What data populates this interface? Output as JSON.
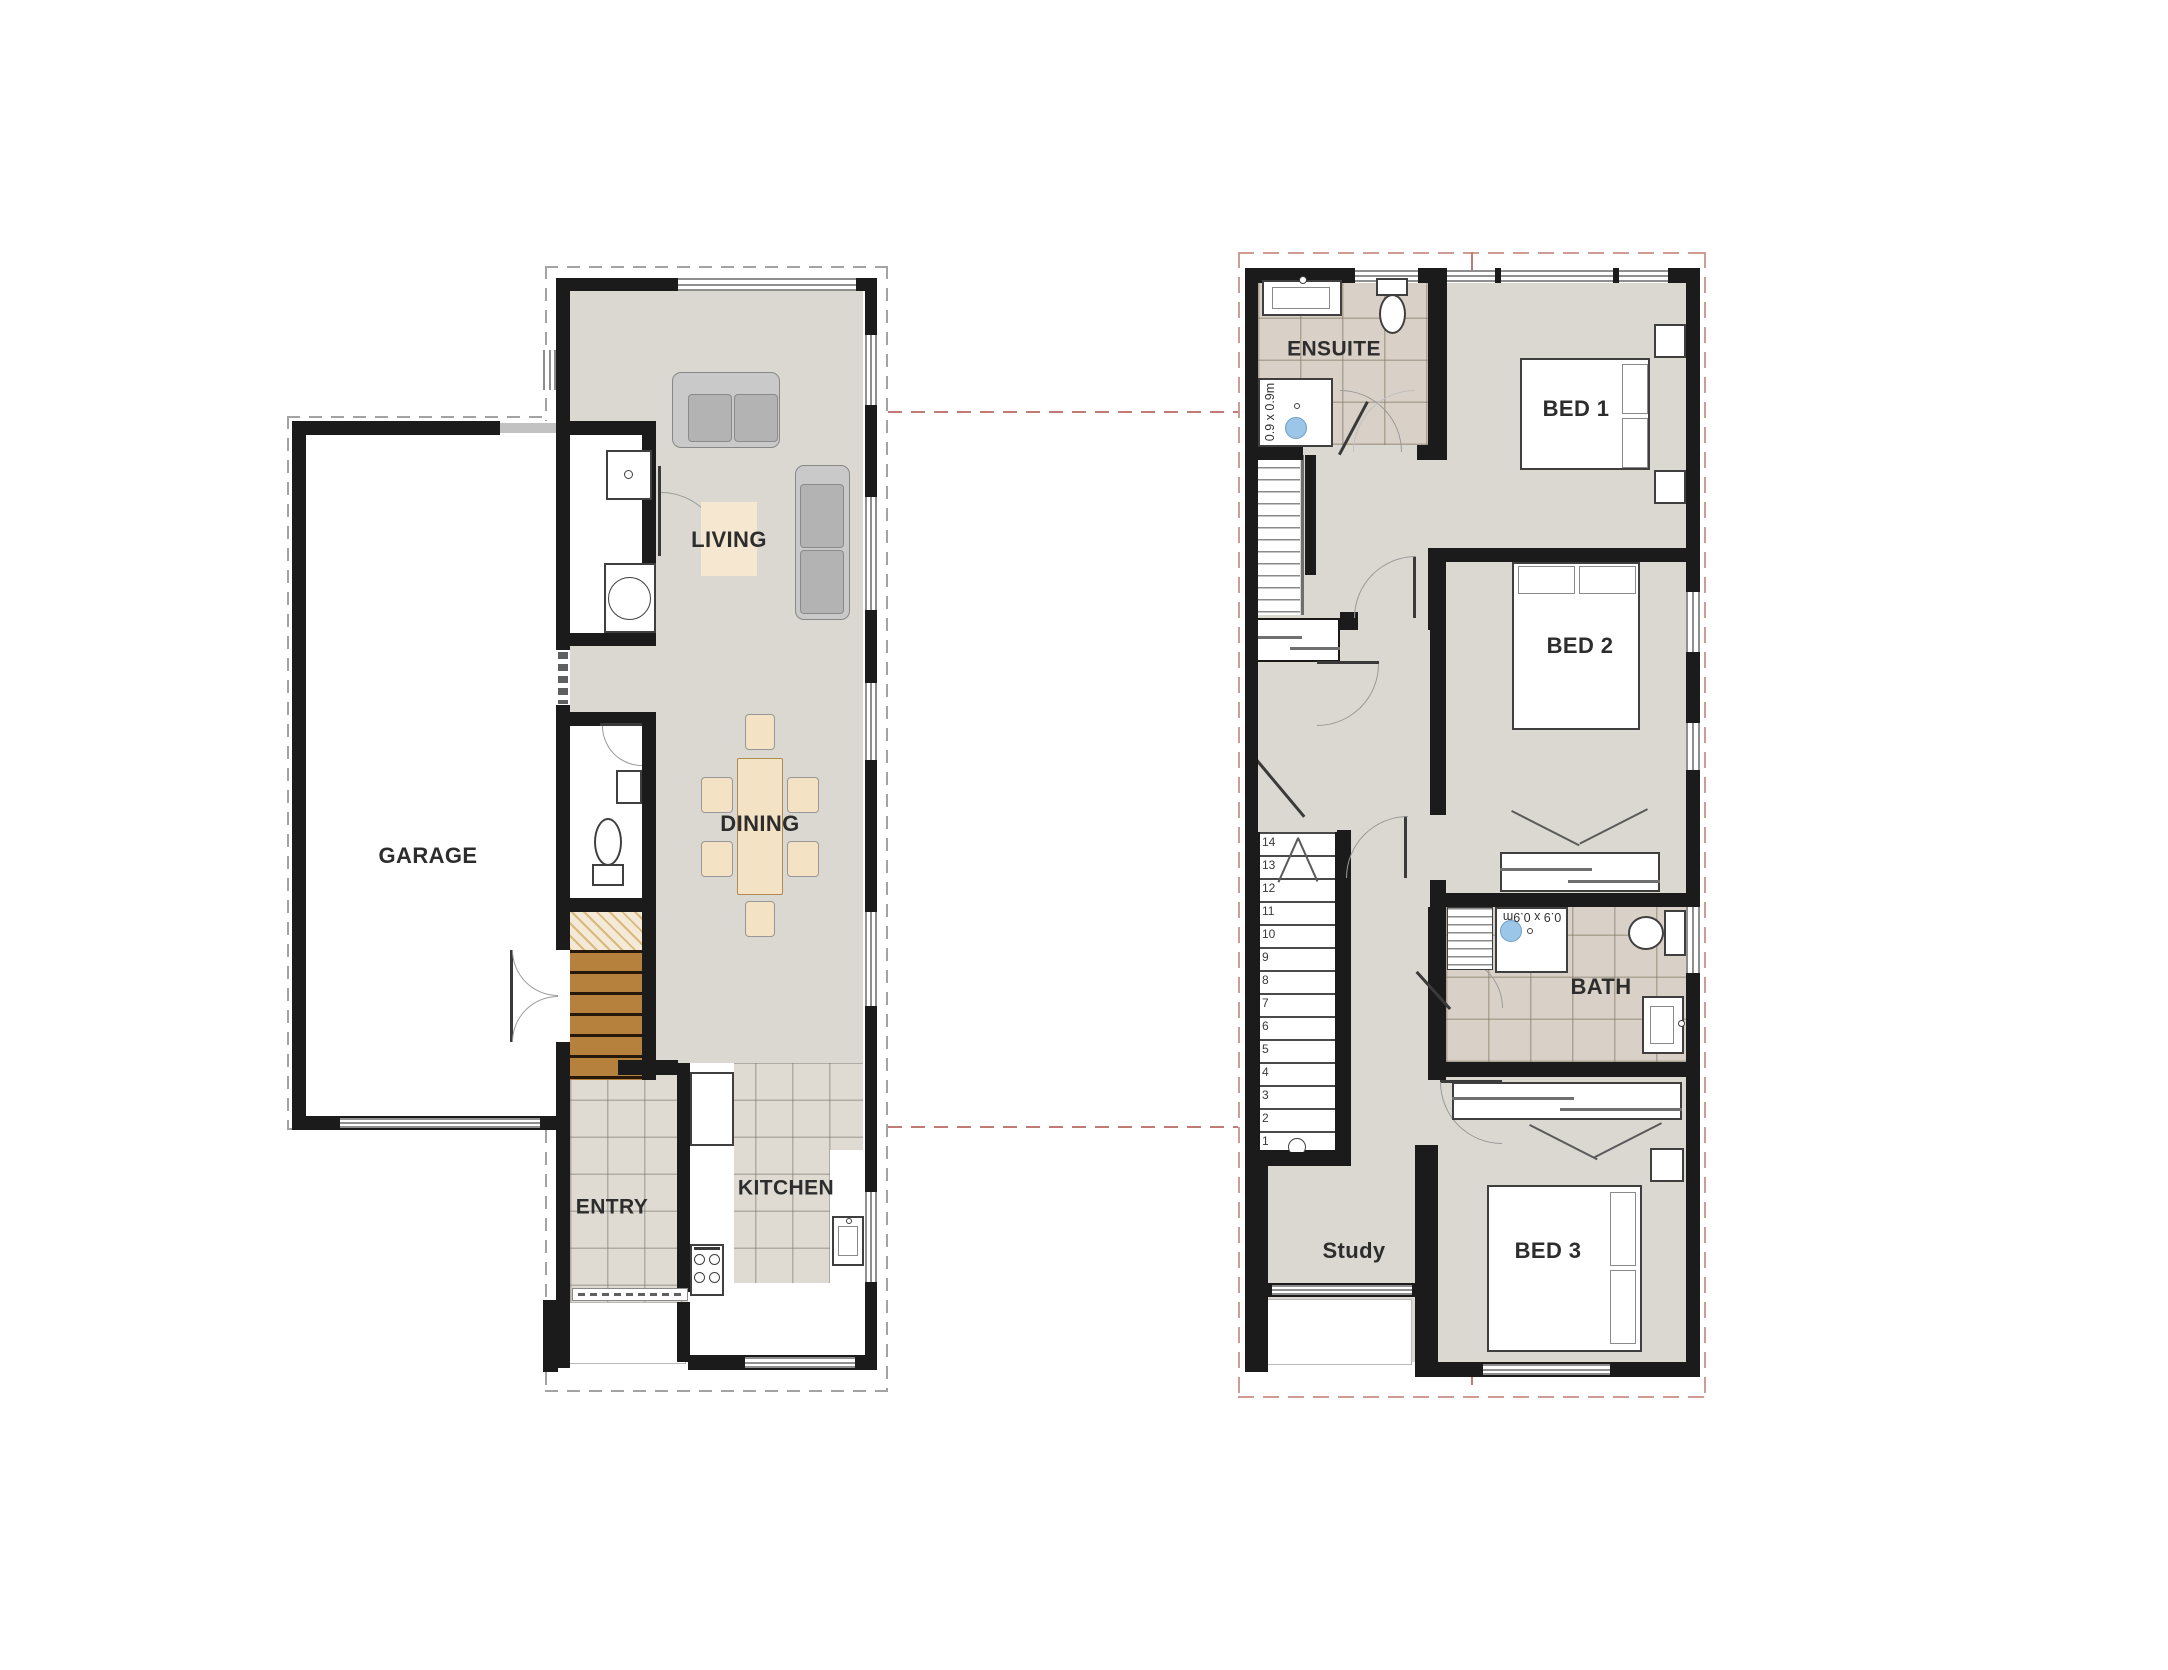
{
  "ground_floor": {
    "garage_label": "GARAGE",
    "living_label": "LIVING",
    "dining_label": "DINING",
    "entry_label": "ENTRY",
    "kitchen_label": "KITCHEN"
  },
  "upper_floor": {
    "ensuite_label": "ENSUITE",
    "bed1_label": "BED 1",
    "bed2_label": "BED 2",
    "bath_label": "BATH",
    "bed3_label": "BED 3",
    "study_label": "Study",
    "ensuite_shower_size": "0.9 x 0.9m",
    "bath_shower_size": "0.9 x 0.9m",
    "stair_step_numbers": [
      "14",
      "13",
      "12",
      "11",
      "10",
      "9",
      "8",
      "7",
      "6",
      "5",
      "4",
      "3",
      "2",
      "1"
    ]
  },
  "colors": {
    "wall": "#1b1b1b",
    "floor_gray": "#dbd8d1",
    "tile_floor": "#dfdbd3",
    "bath_tile": "#d9d1c7",
    "stair_wood": "#b5813c",
    "rug_tan": "#f6e7d0",
    "table_tan": "#f4e2c4",
    "shower_blue": "#9cc6e8",
    "section_red": "#bf7b74",
    "boundary_pink": "#cf9c95",
    "label_ink": "#2d2d2d"
  }
}
